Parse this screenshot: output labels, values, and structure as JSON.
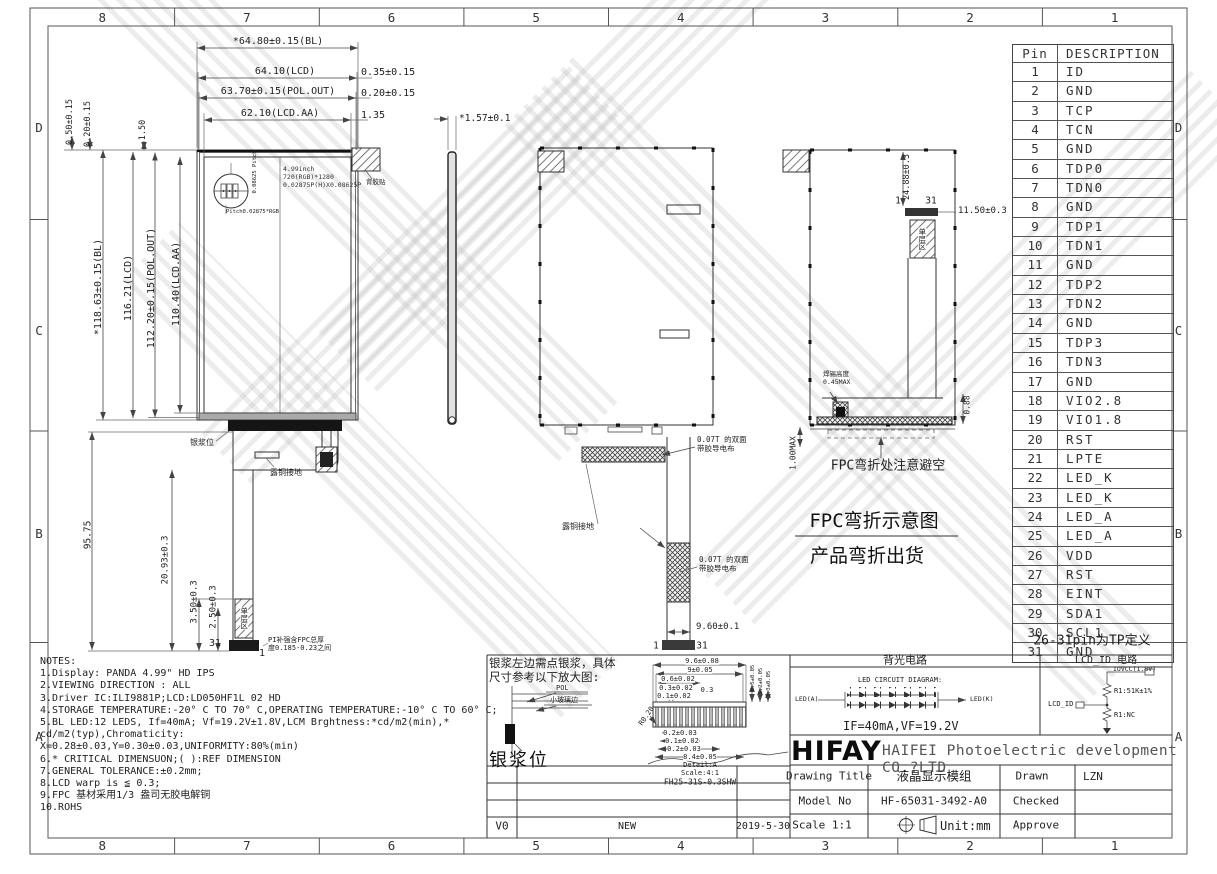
{
  "sheet": {
    "zone_cols": [
      "8",
      "7",
      "6",
      "5",
      "4",
      "3",
      "2",
      "1"
    ],
    "zone_rows": [
      "D",
      "C",
      "B",
      "A"
    ]
  },
  "pin_table": {
    "headers": [
      "Pin",
      "DESCRIPTION"
    ],
    "rows": [
      [
        "1",
        "ID"
      ],
      [
        "2",
        "GND"
      ],
      [
        "3",
        "TCP"
      ],
      [
        "4",
        "TCN"
      ],
      [
        "5",
        "GND"
      ],
      [
        "6",
        "TDP0"
      ],
      [
        "7",
        "TDN0"
      ],
      [
        "8",
        "GND"
      ],
      [
        "9",
        "TDP1"
      ],
      [
        "10",
        "TDN1"
      ],
      [
        "11",
        "GND"
      ],
      [
        "12",
        "TDP2"
      ],
      [
        "13",
        "TDN2"
      ],
      [
        "14",
        "GND"
      ],
      [
        "15",
        "TDP3"
      ],
      [
        "16",
        "TDN3"
      ],
      [
        "17",
        "GND"
      ],
      [
        "18",
        "VIO2.8"
      ],
      [
        "19",
        "VIO1.8"
      ],
      [
        "20",
        "RST"
      ],
      [
        "21",
        "LPTE"
      ],
      [
        "22",
        "LED_K"
      ],
      [
        "23",
        "LED_K"
      ],
      [
        "24",
        "LED_A"
      ],
      [
        "25",
        "LED_A"
      ],
      [
        "26",
        "VDD"
      ],
      [
        "27",
        "RST"
      ],
      [
        "28",
        "EINT"
      ],
      [
        "29",
        "SDA1"
      ],
      [
        "30",
        "SCL1"
      ],
      [
        "31",
        "GND"
      ]
    ],
    "footer": "26-31pin为TP定义"
  },
  "notes": {
    "lines": [
      "NOTES:",
      "1.Display: PANDA 4.99\" HD IPS",
      "2.VIEWING DIRECTION : ALL",
      "3.Driver IC:ILI9881P;LCD:LD050HF1L 02 HD",
      "4.STORAGE TEMPERATURE:-20° C TO 70° C,OPERATING TEMPERATURE:-10° C TO 60° C;",
      "5.BL LED:12 LEDS, If=40mA; Vf=19.2V±1.8V,LCM Brghtness:*cd/m2(min),*",
      "cd/m2(typ),Chromaticity:",
      "X=0.28±0.03,Y=0.30±0.03,UNIFORMITY:80%(min)",
      "6.* CRITICAL DIMENSUON;( ):REF DIMENSION",
      "7.GENERAL TOLERANCE:±0.2mm;",
      "8.LCD warp is ≦ 0.3;",
      "9.FPC 基材采用1/3 盎司无胶电解铜",
      "10.ROHS"
    ]
  },
  "front_view": {
    "dim_width_bl": "*64.80±0.15(BL)",
    "dim_width_lcd": "64.10(LCD)",
    "dim_width_pol": "63.70±0.15(POL.OUT)",
    "dim_width_aa": "62.10(LCD.AA)",
    "offset_lcd": "0.35±0.15",
    "offset_pol": "0.20±0.15",
    "offset_aa": "1.35",
    "dim_h_bl": "*118.63±0.15(BL)",
    "dim_h_lcd": "116.21(LCD)",
    "dim_h_pol": "112.20±0.15(POL.OUT)",
    "dim_h_aa": "110.40(LCD.AA)",
    "dim_top_left_1": "0.50±0.15",
    "dim_top_left_2": "0.20±0.15",
    "dim_top_left_3": "1.50",
    "dim_fpc_len": "95.75",
    "dim_tail_1": "20.93±0.3",
    "dim_tail_2": "3.50±0.3",
    "dim_tail_3": "2.50±0.3",
    "screen_info": [
      "4.99inch",
      "720(RGB)*1280",
      "0.02875P(H)X0.08625P"
    ],
    "pitch_v": "0.08625 Pitch",
    "pitch_h": "Pitch0.02875*RGB",
    "corner_label": "背胶贴",
    "silver_label": "银浆位",
    "copper_label": "露铜接地",
    "single_layer": "单层区",
    "pin31": "31",
    "pin1": "1",
    "pi_note": [
      "PI补强含FPC总厚",
      "度0.185-0.23之间"
    ]
  },
  "side_view": {
    "thickness": "*1.57±0.1"
  },
  "back_view": {
    "cloth_label_1": [
      "0.07T 的双面",
      "带胶导电布"
    ],
    "cloth_label_2": [
      "0.07T 的双面",
      "带胶导电布"
    ],
    "copper_label": "露铜接地",
    "dim_conn": "9.60±0.1",
    "pin1": "1",
    "pin31": "31"
  },
  "bend_view": {
    "dim_fold": "24.88±0.3",
    "pin1": "1",
    "pin31": "31",
    "dim_conn_w": "11.50±0.3",
    "single_layer": "单层区",
    "solder_label": [
      "焊锡高度",
      "0.45MAX"
    ],
    "dim_back": "0.88",
    "dim_max": "1.00MAX",
    "avoid_label": "FPC弯折处注意避空",
    "title1": "FPC弯折示意图",
    "title2": "产品弯折出货"
  },
  "silver_panel": {
    "note": [
      "银浆左边需点银浆，具体",
      "尺寸参考以下放大图:"
    ],
    "pol_label": "POL",
    "glass_label": "小玻璃边",
    "silver_label": "银浆位"
  },
  "detail_a": {
    "top_dims": [
      "9.6±0.08",
      "9±0.05",
      "0.6±0.02",
      "0.3±0.02",
      "0.1±0.02",
      "0.3"
    ],
    "bottom_dims": [
      "0.2±0.03",
      "0.1±0.02",
      "0.2±0.03",
      "8.4±0.05"
    ],
    "side_dims": [
      "0.5±0.05",
      "1.2±0.05",
      "2.3±0.05"
    ],
    "radius": "R0.20",
    "caption": [
      "Detail:A",
      "Scale:4:1",
      "FH25-31S-0.3SHW"
    ]
  },
  "revision": {
    "rev": "V0",
    "desc": "NEW",
    "date": "2019-5-30"
  },
  "title_block": {
    "backlight_header": "背光电路",
    "led_diagram_label": "LED CIRCUIT DIAGRAM:",
    "led_a": "LED(A)",
    "led_k": "LED(K)",
    "if_vf": "IF=40mA,VF=19.2V",
    "lcdid_header": "LCD_ID 电路",
    "iovcc": "IOVCC(1.8V)",
    "r1_top": "R1:51K±1%",
    "lcd_id": "LCD_ID",
    "r1_bottom": "R1:NC",
    "logo": "HIFAY",
    "company": "HAIFEI Photoelectric development CO.?LTD",
    "row1_label": "Drawing Title",
    "row1_value": "液晶显示模组",
    "row1_label2": "Drawn",
    "row1_value2": "LZN",
    "row2_label": "Model No",
    "row2_value": "HF-65031-3492-A0",
    "row2_label2": "Checked",
    "row3_label": "Scale 1:1",
    "row3_value": "Unit:mm",
    "row3_label2": "Approve"
  }
}
